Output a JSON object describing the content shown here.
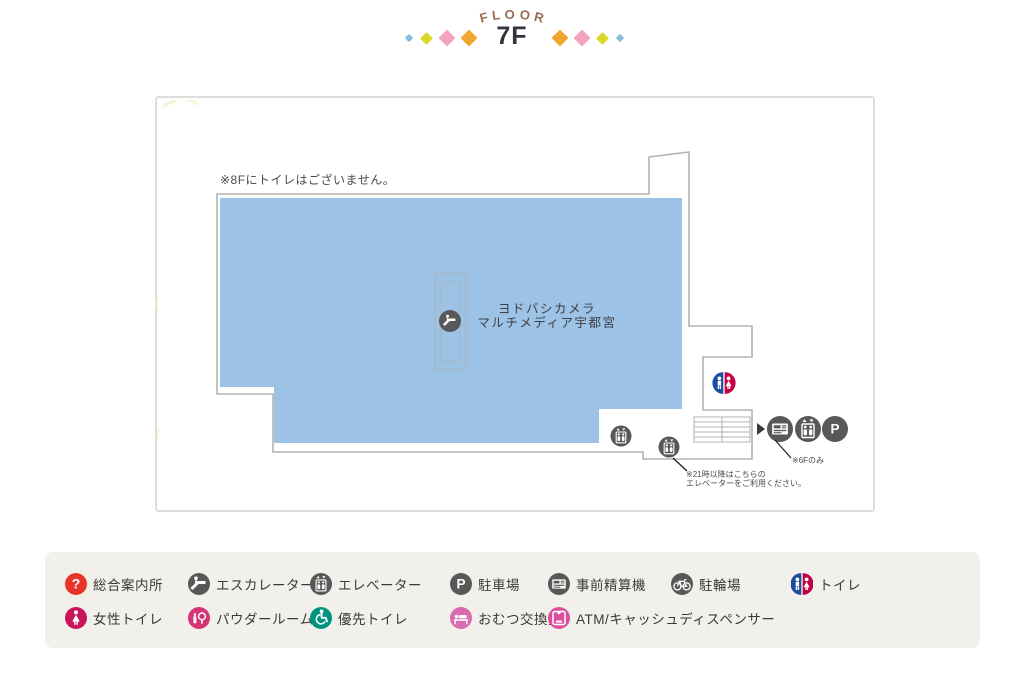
{
  "header": {
    "floor_label": "FLOOR",
    "floor_letters": [
      "F",
      "L",
      "O",
      "O",
      "R"
    ],
    "floor_number": "7F",
    "diamond_colors": {
      "blue": "#85bce0",
      "yellow": "#d9d826",
      "pink": "#f2a3bd",
      "orange": "#f0a72e"
    }
  },
  "map": {
    "note_8f": "※8Fにトイレはございません。",
    "store": {
      "line1": "ヨドバシカメラ",
      "line2": "マルチメディア宇都宮"
    },
    "elevator_note": {
      "line1": "※21時以降はこちらの",
      "line2": "エレベーターをご利用ください。"
    },
    "payment_note": "※6Fのみ",
    "colors": {
      "area_fill": "#9cc2e5",
      "wall": "#b3b3b3",
      "icon_gray": "#595757",
      "toilet_blue": "#1c4ea0",
      "toilet_red": "#c40042",
      "leader_line": "#1a1a1a"
    }
  },
  "legend": {
    "background": "#f2f0ea",
    "row1": [
      {
        "icon": "info-icon",
        "label": "総合案内所",
        "color": "#e8342a"
      },
      {
        "icon": "escalator-icon",
        "label": "エスカレーター",
        "color": "#595757"
      },
      {
        "icon": "elevator-icon",
        "label": "エレベーター",
        "color": "#595757"
      },
      {
        "icon": "parking-icon",
        "label": "駐車場",
        "color": "#595757"
      },
      {
        "icon": "payment-machine-icon",
        "label": "事前精算機",
        "color": "#595757"
      },
      {
        "icon": "bicycle-parking-icon",
        "label": "駐輪場",
        "color": "#595757"
      },
      {
        "icon": "toilet-icon",
        "label": "トイレ",
        "color": "split"
      }
    ],
    "row2": [
      {
        "icon": "female-toilet-icon",
        "label": "女性トイレ",
        "color": "#c9135a"
      },
      {
        "icon": "powder-room-icon",
        "label": "パウダールーム",
        "color": "#d53576"
      },
      {
        "icon": "priority-toilet-icon",
        "label": "優先トイレ",
        "color": "#009480"
      },
      {
        "icon": "diaper-changing-icon",
        "label": "おむつ交換室",
        "color": "#d96bb1"
      },
      {
        "icon": "atm-icon",
        "label": "ATM/キャッシュディスペンサー",
        "color": "#db4f9e"
      }
    ]
  }
}
